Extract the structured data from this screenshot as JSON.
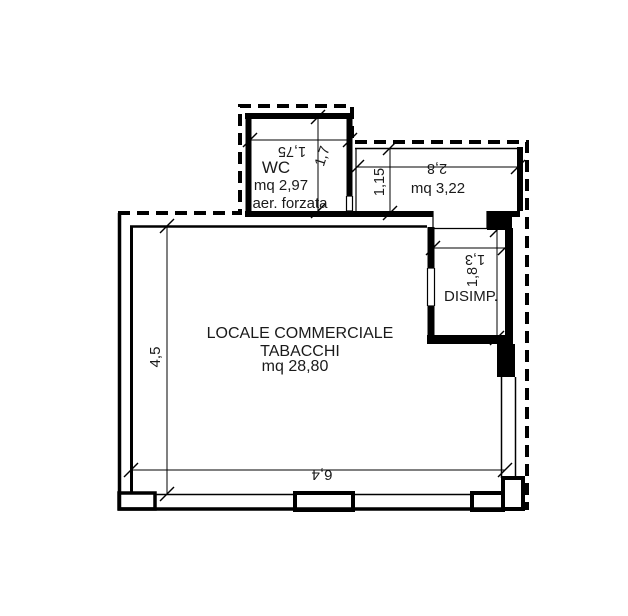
{
  "plan": {
    "type": "cadastral-floor-plan",
    "colors": {
      "line": "#000000",
      "text": "#1a1a1a",
      "background": "#ffffff"
    },
    "rooms": {
      "main": {
        "name_line1": "LOCALE COMMERCIALE",
        "name_line2": "TABACCHI",
        "area": "mq 28,80",
        "dim_width": "6,4",
        "dim_height": "4,5"
      },
      "wc": {
        "name": "WC",
        "area": "mq 2,97",
        "note": "aer. forzata",
        "dim_width": "1,75",
        "dim_height": "1,7"
      },
      "room322": {
        "area": "mq 3,22",
        "dim_width": "2,8",
        "dim_height": "1,15"
      },
      "disimpegno": {
        "name": "DISIMP.",
        "dim_width": "1,3",
        "dim_height": "1,8"
      }
    }
  }
}
